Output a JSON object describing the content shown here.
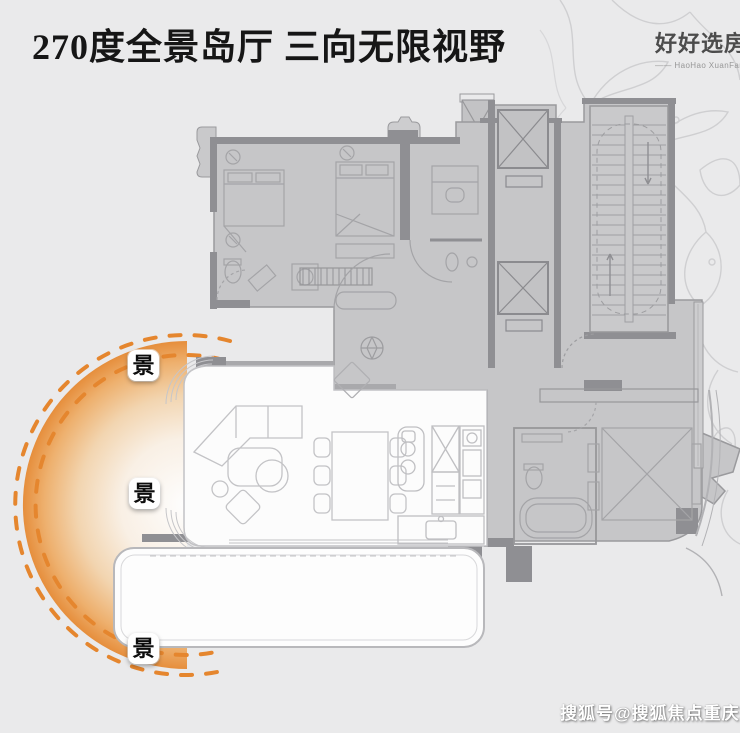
{
  "title": "270度全景岛厅 三向无限视野",
  "logo": {
    "name": "好好选房",
    "tagline": "—— HaoHao XuanFang ——"
  },
  "view_badges": [
    {
      "label": "景"
    },
    {
      "label": "景"
    },
    {
      "label": "景"
    }
  ],
  "watermark": "搜狐号@搜狐焦点重庆站庆",
  "colors": {
    "background": "#eaeaeb",
    "plan_fill": "#c6c6c8",
    "plan_wall": "#8f8f93",
    "plan_line": "#a4a4a7",
    "white_room": "#fcfcfc",
    "accent_orange": "#e5862e",
    "title_color": "#161616"
  }
}
